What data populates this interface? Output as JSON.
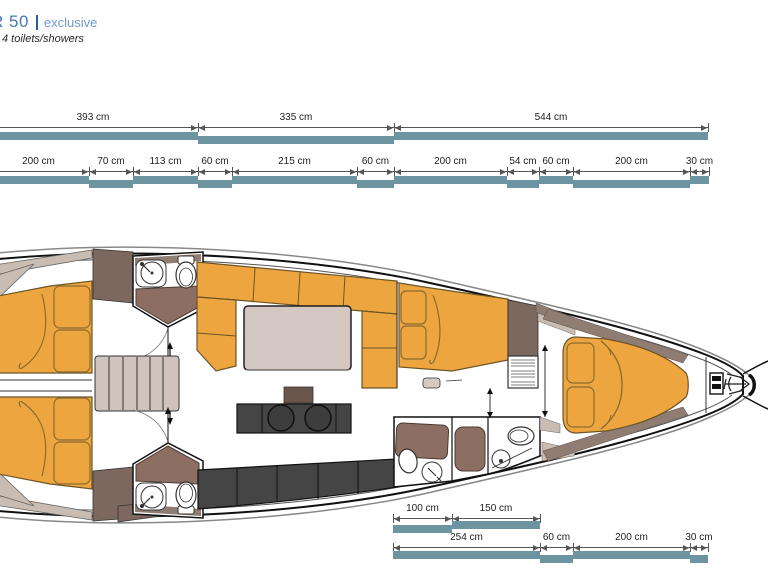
{
  "header": {
    "model_partial": "R 50",
    "edition": "exclusive",
    "features": "4 toilets/showers"
  },
  "colors": {
    "teal_bar": "#6d95a1",
    "dim_line": "#555555",
    "orange_furniture": "#eda63f",
    "taupe_liner": "#c9bcb2",
    "brown_cabinet": "#7c685f",
    "counter_dark": "#454545",
    "title_blue": "#4878b4"
  },
  "dimension_rows": [
    {
      "name": "hull-sections-top",
      "line_y": 127,
      "bar_y": 132,
      "label_y": 112,
      "segments": [
        {
          "label": "393 cm",
          "x1": -12,
          "x2": 198,
          "lvl": 0
        },
        {
          "label": "335 cm",
          "x1": 198,
          "x2": 394,
          "lvl": 1
        },
        {
          "label": "544 cm",
          "x1": 394,
          "x2": 708,
          "lvl": 0
        }
      ]
    },
    {
      "name": "interior-sections-top",
      "line_y": 171,
      "bar_y": 176,
      "label_y": 156,
      "segments": [
        {
          "label": "200 cm",
          "x1": -12,
          "x2": 89,
          "lvl": 0
        },
        {
          "label": "70 cm",
          "x1": 89,
          "x2": 133,
          "lvl": 1
        },
        {
          "label": "113 cm",
          "x1": 133,
          "x2": 198,
          "lvl": 0
        },
        {
          "label": "60 cm",
          "x1": 198,
          "x2": 232,
          "lvl": 1
        },
        {
          "label": "215 cm",
          "x1": 232,
          "x2": 357,
          "lvl": 0
        },
        {
          "label": "60 cm",
          "x1": 357,
          "x2": 394,
          "lvl": 1
        },
        {
          "label": "200 cm",
          "x1": 394,
          "x2": 507,
          "lvl": 0
        },
        {
          "label": "54 cm",
          "x1": 507,
          "x2": 539,
          "lvl": 1
        },
        {
          "label": "60 cm",
          "x1": 539,
          "x2": 573,
          "lvl": 0
        },
        {
          "label": "200 cm",
          "x1": 573,
          "x2": 690,
          "lvl": 1
        },
        {
          "label": "30 cm",
          "x1": 690,
          "x2": 709,
          "lvl": 0
        }
      ]
    },
    {
      "name": "bath-sections-bottom",
      "line_y": 518,
      "bar_y": 521,
      "label_y": 503,
      "segments": [
        {
          "label": "100 cm",
          "x1": 393,
          "x2": 452,
          "lvl": 1
        },
        {
          "label": "150 cm",
          "x1": 452,
          "x2": 540,
          "lvl": 0
        }
      ]
    },
    {
      "name": "interior-sections-bottom",
      "line_y": 547,
      "bar_y": 551,
      "label_y": 532,
      "segments": [
        {
          "label": "254 cm",
          "x1": 393,
          "x2": 540,
          "lvl": 0
        },
        {
          "label": "60 cm",
          "x1": 540,
          "x2": 573,
          "lvl": 1
        },
        {
          "label": "200 cm",
          "x1": 573,
          "x2": 690,
          "lvl": 0
        },
        {
          "label": "30 cm",
          "x1": 690,
          "x2": 708,
          "lvl": 1
        }
      ]
    }
  ]
}
